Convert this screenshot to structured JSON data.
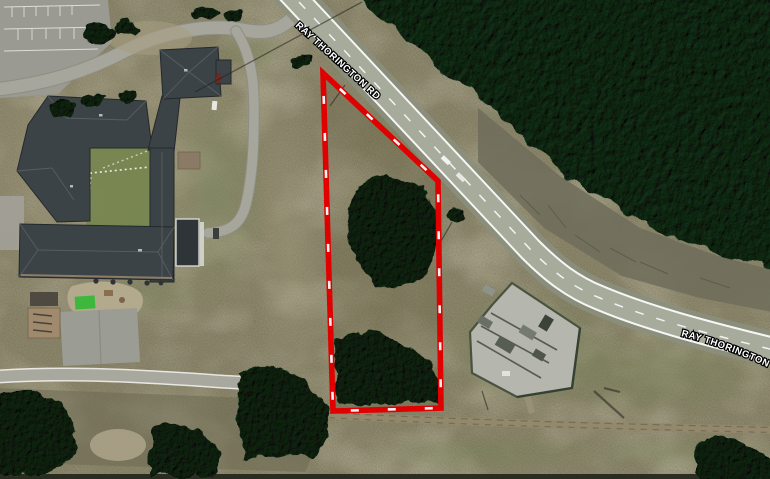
{
  "map": {
    "description": "Aerial satellite view with red-dashed parcel boundary highlight",
    "road_labels": [
      {
        "text": "RAY THORINGTON RD",
        "placement": "upper-left, rotated along road"
      },
      {
        "text": "RAY THORINGTON RD",
        "placement": "lower-right, rotated along road, clipped at edge"
      }
    ],
    "parcel": {
      "outline_color": "#e10000",
      "dash_color": "#ffffff",
      "shape": "elongated quadrilateral",
      "vertices_px": [
        [
          323,
          73
        ],
        [
          438,
          181
        ],
        [
          441,
          408
        ],
        [
          333,
          411
        ]
      ]
    },
    "features": {
      "forest": "dense evergreen woods, upper right",
      "school_complex": "dark hip-roofed building complex, left",
      "parking_lot": "striped parking lot, top left",
      "loop_driveway": "curving school driveway, top left",
      "playground": "playground, pavilion and basketball court, lower left",
      "substation": "fenced electrical substation gravel pad, lower center",
      "dirt_track": "dirt track along bottom edge",
      "vehicles": "small white cars on road"
    },
    "palette": {
      "scrub": "#8d886c",
      "forest": "#2e5038",
      "asphalt": "#a7ab9c",
      "roof": "#3c4347",
      "parcel_red": "#e10000"
    }
  }
}
